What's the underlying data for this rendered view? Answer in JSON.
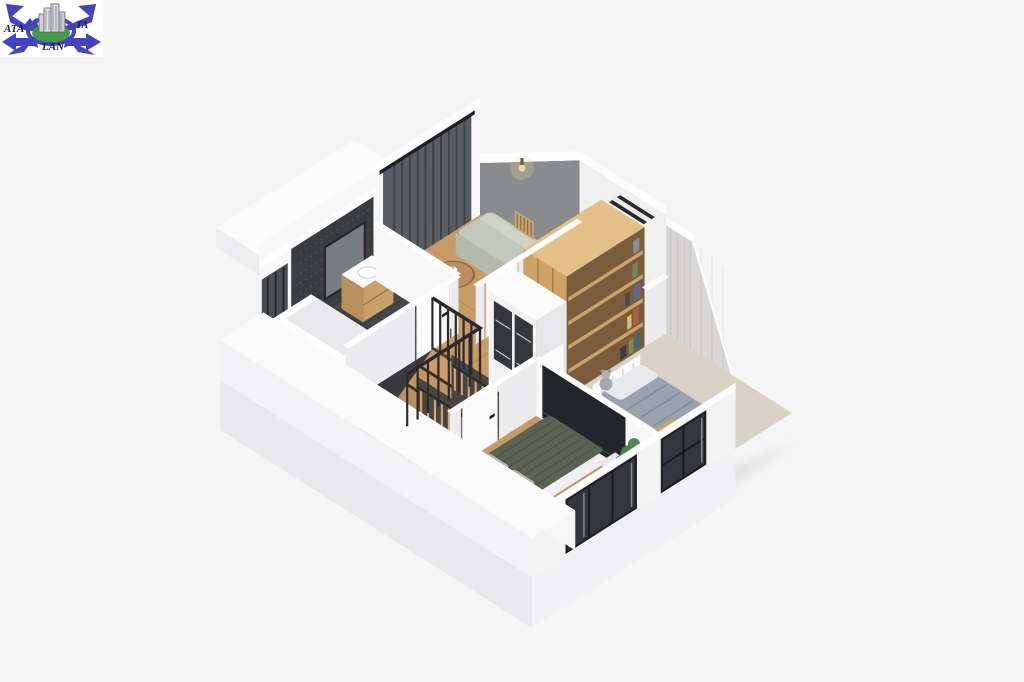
{
  "logo": {
    "text_left": "ATA",
    "text_right": "TA",
    "text_bottom": "LAN"
  },
  "colors": {
    "background": "#f5f5f6",
    "wall_white": "#f4f4f5",
    "attic_gray": "#8a8b8c",
    "kids_wall_texture": "#d5d4d2",
    "wood_floor": "#c89b66",
    "wood_dark": "#a67a48",
    "tile_dark": "#45484b",
    "accent_wall": "#3a3d40",
    "mirror_glass": "#767d82",
    "entry_glass": "#4b4f54",
    "curtain": "#595d61",
    "sofa": "#c3c8bb",
    "sofa_shade": "#b4baac",
    "sofa_back": "#ced3c6",
    "sofa_cushion": "#c8a671",
    "table_wood": "#bb8f5f",
    "wardrobe_wood": "#cfa268",
    "wardrobe_side": "#b98e55",
    "shelf_brown": "#7a5c3b",
    "closet_dark": "#4a463f",
    "hanger_wood": "#d2a877",
    "carpet": "#d8d2c6",
    "duvet_kids": "#9aa2ab",
    "pillow_white": "#e8e9eb",
    "duvet_master": "#5c6355",
    "pillow_sage": "#b3b7a8",
    "chair_blue": "#a9c3d0",
    "plant_green": "#4e7d46",
    "tv_dark": "#232628",
    "railing_black": "#2b2b2d",
    "window_glass": "#33363a",
    "logo_blue": "#4343bf",
    "logo_green": "#3f9c3f",
    "logo_text": "#1b1b60"
  }
}
